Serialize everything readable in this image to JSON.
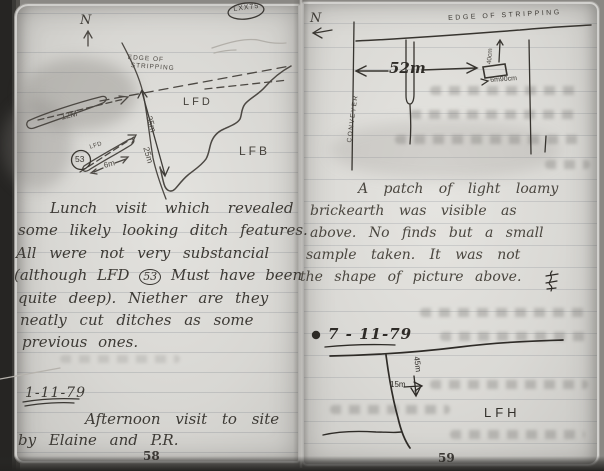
{
  "palette": {
    "paper": "#d8d7d3",
    "ink": "#33302c",
    "pencil": "#56524c",
    "ghost": "#aeaba6"
  },
  "page_tag": "LXX75",
  "left_page": {
    "page_number": "58",
    "diagram": {
      "north": "N",
      "edge_line1": "EDGE OF",
      "edge_line2": "STRIPPING",
      "len_12m": "12M",
      "len_35m": "35m",
      "len_25m": "25m",
      "len_6m": "6m",
      "lfd_small": "LFD",
      "lfd_number": "53",
      "lfd_area": "LFD",
      "lfb_area": "LFB"
    },
    "entry_lunch": {
      "line1": "Lunch visit which revealed",
      "line2": "some likely looking ditch features.",
      "line3": "All were not very substancial",
      "line4_pre": "(although LFD",
      "line4_circled": "53",
      "line4_post": "Must have been",
      "line5": "quite deep). Niether are they",
      "line6": "neatly cut ditches as some",
      "line7": "previous ones."
    },
    "entry_afternoon": {
      "date": "1-11-79",
      "line1": "Afternoon visit to site",
      "line2": "by Elaine and P.R."
    }
  },
  "right_page": {
    "page_number": "59",
    "diagram": {
      "north": "N",
      "edge": "EDGE OF STRIPPING",
      "conveyor": "CONVEYER",
      "dist_52m": "52m",
      "depth_40cm": "40cm",
      "dist_6m90": "6m90cm"
    },
    "entry_brickearth": {
      "line1": "A patch of light loamy",
      "line2": "brickearth was visible as",
      "line3": "above. No finds but a small",
      "line4": "sample taken. It was not",
      "line5": "the shape of picture above."
    },
    "entry_nov7": {
      "date": "7 - 11-79",
      "dist_45m": "45m",
      "dist_15m": "15m",
      "lfh_area": "LFH"
    }
  }
}
